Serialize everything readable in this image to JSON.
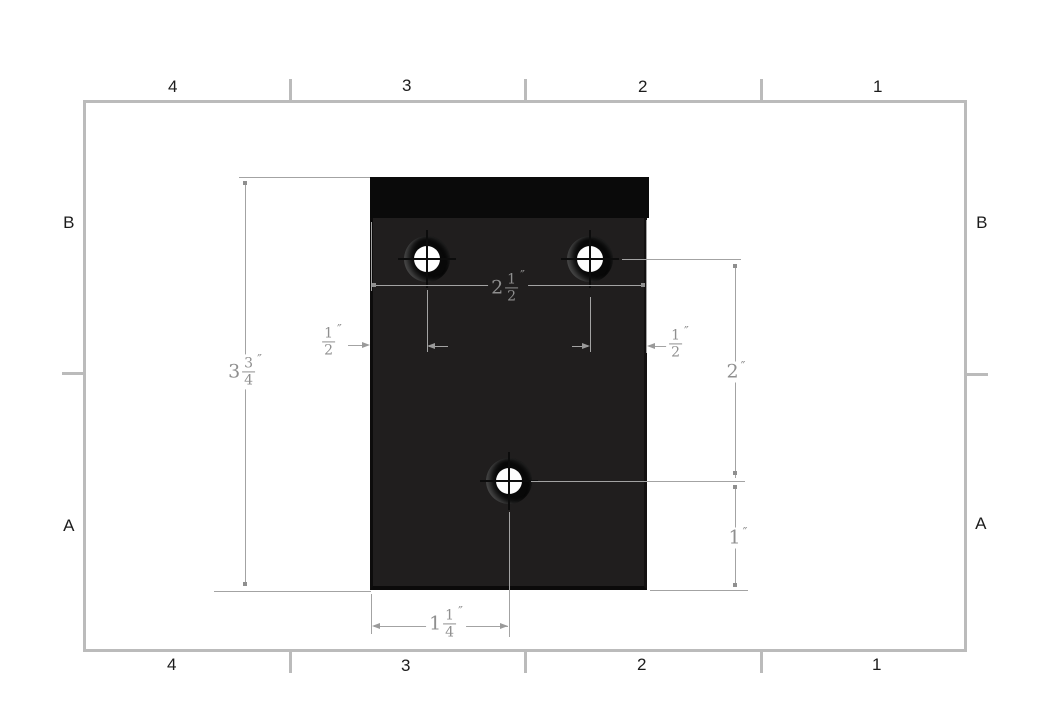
{
  "sheet": {
    "zone_labels": {
      "top": [
        "4",
        "3",
        "2",
        "1"
      ],
      "bottom": [
        "4",
        "3",
        "2",
        "1"
      ],
      "left": [
        "B",
        "A"
      ],
      "right": [
        "B",
        "A"
      ]
    }
  },
  "dimensions": {
    "plate_height": {
      "whole": "3",
      "num": "3",
      "den": "4",
      "unit": "″"
    },
    "plate_width": {
      "whole": "2",
      "num": "1",
      "den": "2",
      "unit": "″"
    },
    "left_hole_offset": {
      "num": "1",
      "den": "2",
      "unit": "″"
    },
    "right_hole_offset": {
      "num": "1",
      "den": "2",
      "unit": "″"
    },
    "hole_row_spacing": {
      "whole": "2",
      "unit": "″"
    },
    "bottom_hole_height": {
      "whole": "1",
      "unit": "″"
    },
    "bottom_hole_x_offset": {
      "whole": "1",
      "num": "1",
      "den": "4",
      "unit": "″"
    }
  },
  "colors": {
    "frame_border": "#bbbbbb",
    "plate_top_band": "#0a0a0a",
    "plate_body": "#201e1e",
    "dimension_line": "#a3a3a3",
    "dimension_text": "#8f8f8f",
    "zone_label": "#1c1c1c"
  }
}
